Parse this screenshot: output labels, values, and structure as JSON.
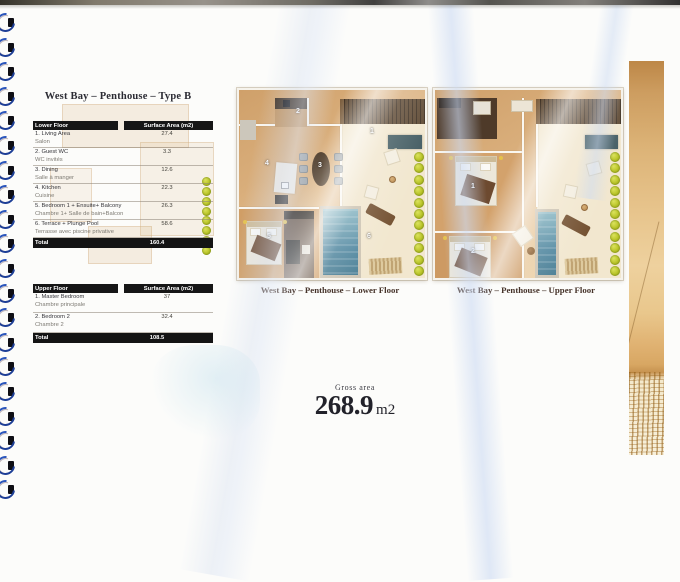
{
  "page": {
    "title": "West Bay – Penthouse – Type B",
    "gross_area_label": "Gross area",
    "gross_area_value": "268.9",
    "gross_area_unit": "m2"
  },
  "lower_table": {
    "header": [
      "Lower Floor",
      "Surface Area (m2)"
    ],
    "rows": [
      {
        "en": "1. Living Area",
        "fr": "Salon",
        "value": "27.4"
      },
      {
        "en": "2. Guest WC",
        "fr": "WC invités",
        "value": "3.3"
      },
      {
        "en": "3. Dining",
        "fr": "Salle à manger",
        "value": "12.6"
      },
      {
        "en": "4. Kitchen",
        "fr": "Cuisine",
        "value": "22.3"
      },
      {
        "en": "5. Bedroom 1 + Ensuite+ Balcony",
        "fr": "Chambre 1+ Salle de bain+Balcon",
        "value": "26.3"
      },
      {
        "en": "6. Terrace + Plunge Pool",
        "fr": "Terrasse avec piscine privative",
        "value": "58.6"
      }
    ],
    "total_label": "Total",
    "total_value": "160.4"
  },
  "upper_table": {
    "header": [
      "Upper Floor",
      "Surface Area (m2)"
    ],
    "rows": [
      {
        "en": "1. Master Bedroom",
        "fr": "Chambre principale",
        "value": "37"
      },
      {
        "en": "2. Bedroom 2",
        "fr": "Chambre 2",
        "value": "32.4"
      }
    ],
    "total_label": "Total",
    "total_value": "108.5"
  },
  "plans": {
    "lower": {
      "caption": "West Bay – Penthouse – Lower Floor",
      "room_numbers": [
        "1",
        "2",
        "3",
        "4",
        "5",
        "6"
      ]
    },
    "upper": {
      "caption": "West Bay – Penthouse – Upper Floor",
      "room_numbers": [
        "1",
        "2"
      ]
    }
  },
  "colors": {
    "table_header_bg": "#161616",
    "floor_beige": "#d9ae7b",
    "terrace_cream": "#f1e6cd",
    "pool_blue": "#46809a",
    "tree_green": "#bac529",
    "sofa_teal": "#3b555c",
    "strip_gold": "#e7c48c",
    "coil_blue": "#1d3e96"
  }
}
